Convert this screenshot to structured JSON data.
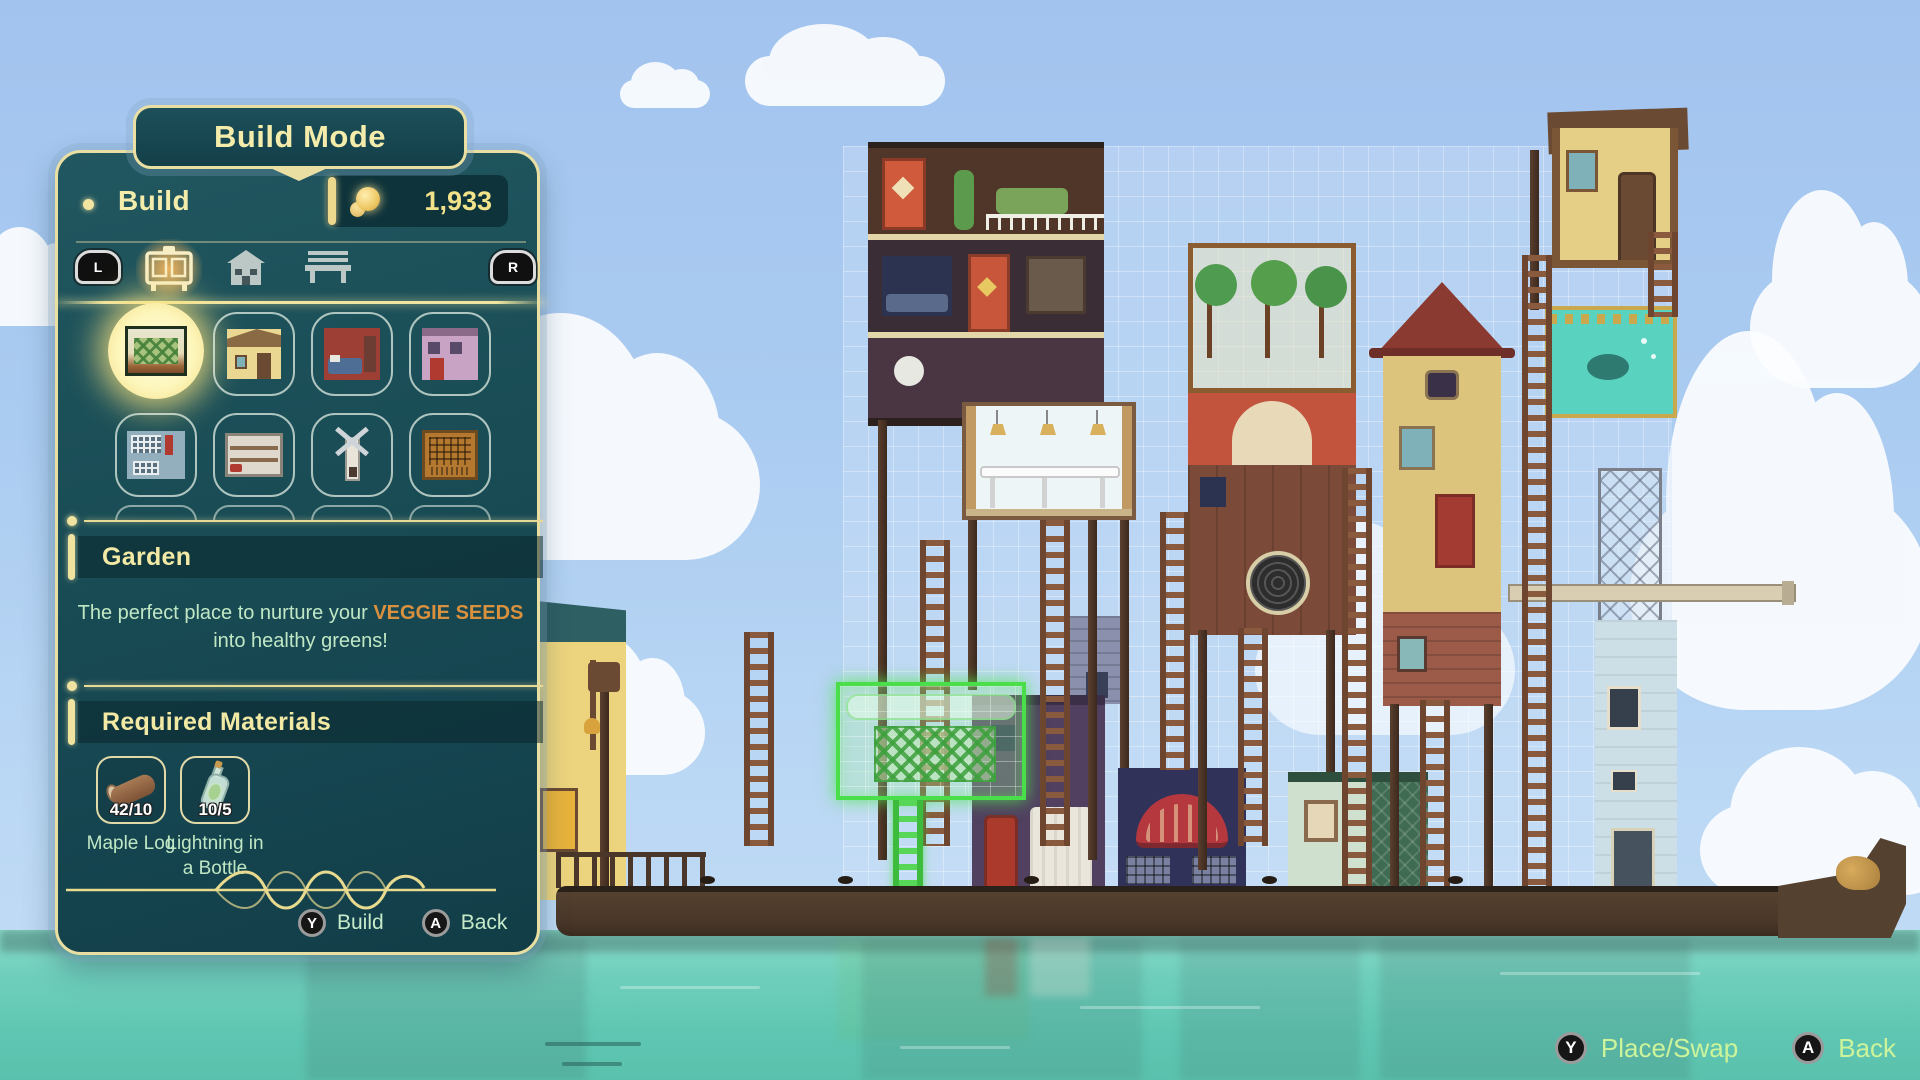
{
  "colors": {
    "panel_teal": "#1a4d56",
    "gold_border": "#e9dfa2",
    "title_text": "#f2e9a4",
    "description_text": "#c0e7c4",
    "description_highlight": "#d9913e",
    "hud_text": "#cdf39b",
    "selected_glow": "#f3dd82",
    "placement_green": "#4ade4a",
    "sky": "#a9c9f2",
    "water": "#6fcfbc"
  },
  "build_panel": {
    "mode_title": "Build Mode",
    "tab_title": "Build",
    "currency": "1,933",
    "shoulder_left": "L",
    "shoulder_right": "R",
    "category_tabs": [
      {
        "name": "furniture",
        "icon": "cabinet-icon",
        "selected": true
      },
      {
        "name": "structures",
        "icon": "house-icon",
        "selected": false
      },
      {
        "name": "decorations",
        "icon": "bench-icon",
        "selected": false
      }
    ],
    "info": {
      "title": "Garden",
      "description_prefix": "The perfect place to nurture your ",
      "description_highlight": "VEGGIE SEEDS",
      "description_line2": "into healthy greens!"
    },
    "materials_title": "Required Materials",
    "materials": [
      {
        "name": "Maple Log",
        "count": "42/10",
        "icon": "log-icon"
      },
      {
        "name": "Lightning in a Bottle",
        "count": "10/5",
        "icon": "bottle-icon"
      }
    ],
    "footer": {
      "build_key": "Y",
      "build_label": "Build",
      "back_key": "A",
      "back_label": "Back"
    }
  },
  "hud": {
    "place_key": "Y",
    "place_label": "Place/Swap",
    "back_key": "A",
    "back_label": "Back"
  }
}
